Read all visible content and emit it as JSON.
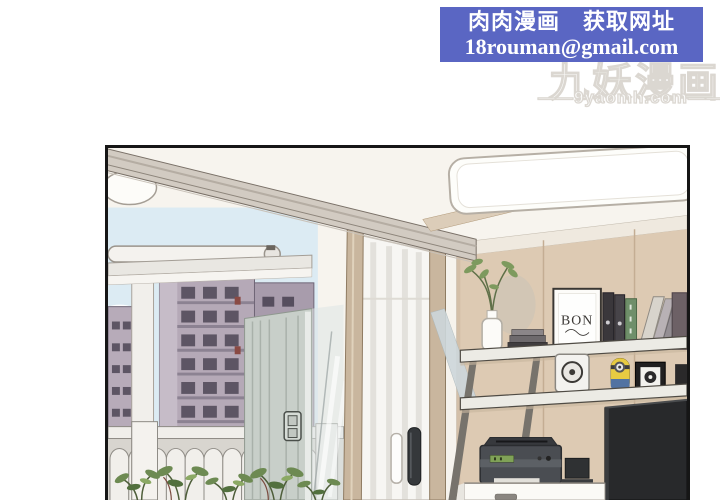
{
  "page": {
    "background": "#ffffff",
    "width": 720,
    "height": 500
  },
  "banner": {
    "line1": "肉肉漫画　获取网址",
    "line2": "18rouman@gmail.com",
    "bg_color": "#5a66c3",
    "text_color": "#ffffff"
  },
  "watermark": {
    "cjk_text": "九妖漫画",
    "dash_left": "——",
    "site_text": "9yaomh.com",
    "dash_right": "——"
  },
  "panel": {
    "art_print_text": "BON",
    "scene": "apartment interior with sliding glass balcony door, city view, wall shelves, printer, tv"
  },
  "colors": {
    "panel_border": "#161616",
    "ceiling": "#f7f4ee",
    "wall_beige": "#ddcab3",
    "beam_taupe": "#d2cbc2",
    "sky_blue": "#dcebf3",
    "building_purple": "#b5a9b7",
    "railing_white": "#f1efeb",
    "stile_graygreen": "#c8cfc9",
    "plant_green": "#6d8a52",
    "tv_dark": "#28292b",
    "printer_dark": "#4a4d52",
    "minion_yellow": "#e8cb42",
    "minion_blue": "#5273a2"
  }
}
